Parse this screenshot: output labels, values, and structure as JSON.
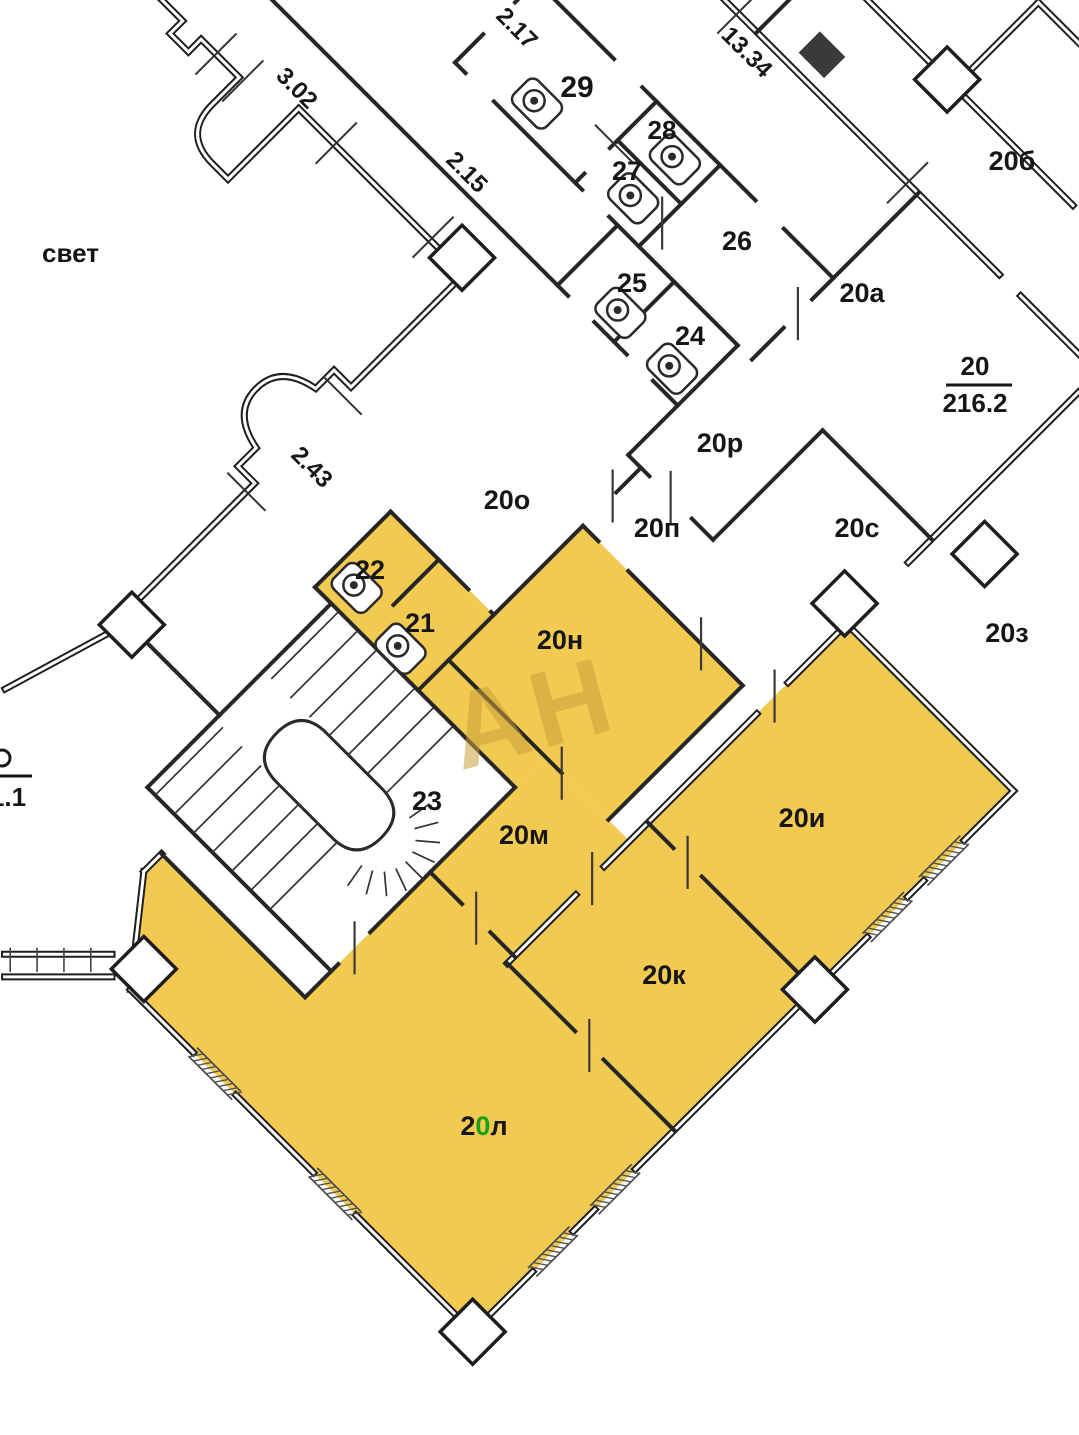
{
  "plan_title": "floor-plan-fragment",
  "watermark": "АН",
  "courtyard_label": "свет",
  "edge_fraction": "1.1",
  "apartment": {
    "number": "20",
    "area": "216.2"
  },
  "dimensions": {
    "d302": "3.02",
    "d215": "2.15",
    "d217": "2.17",
    "d1334": "13.34",
    "d243": "2.43"
  },
  "rooms": {
    "r29": "29",
    "r28": "28",
    "r27": "27",
    "r26": "26",
    "r25": "25",
    "r24": "24",
    "r23": "23",
    "r22": "22",
    "r21": "21",
    "r20b": "20б",
    "r20a": "20а",
    "r20r": "20р",
    "r20o": "20о",
    "r20p": "20п",
    "r20s": "20с",
    "r20z": "20з",
    "r20n": "20н",
    "r20i": "20и",
    "r20m": "20м",
    "r20k": "20к",
    "r20l_prefix": "2",
    "r20l_zero": "0",
    "r20l_suffix": "л"
  },
  "highlighted_rooms": [
    "21",
    "22",
    "20н",
    "20и",
    "20м",
    "20к",
    "20л"
  ],
  "colors": {
    "highlight": "#F2CA52",
    "wall": "#1e1e1e",
    "watermark": "#C9A13B",
    "label": "#161616",
    "green_digit": "#18A018"
  }
}
